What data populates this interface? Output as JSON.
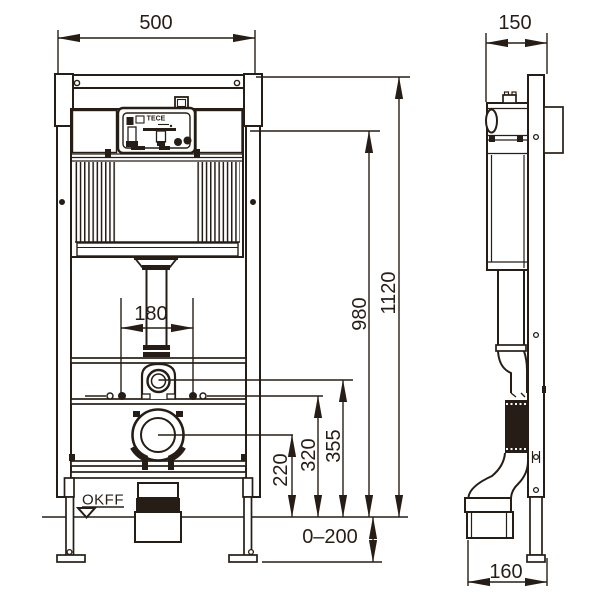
{
  "colors": {
    "ink": "#261e16",
    "paper": "#ffffff"
  },
  "labels": {
    "brand": "TECE",
    "floor_marker": "OKFF"
  },
  "dimensions": {
    "frame_width": "500",
    "frame_depth": "150",
    "frame_height": "1120",
    "cistern_top_height": "980",
    "fixing_bolt_spacing": "180",
    "flush_bend_height": "355",
    "fixing_height": "320",
    "outlet_height": "220",
    "leg_adjustment": "0–200",
    "outlet_offset": "160"
  }
}
